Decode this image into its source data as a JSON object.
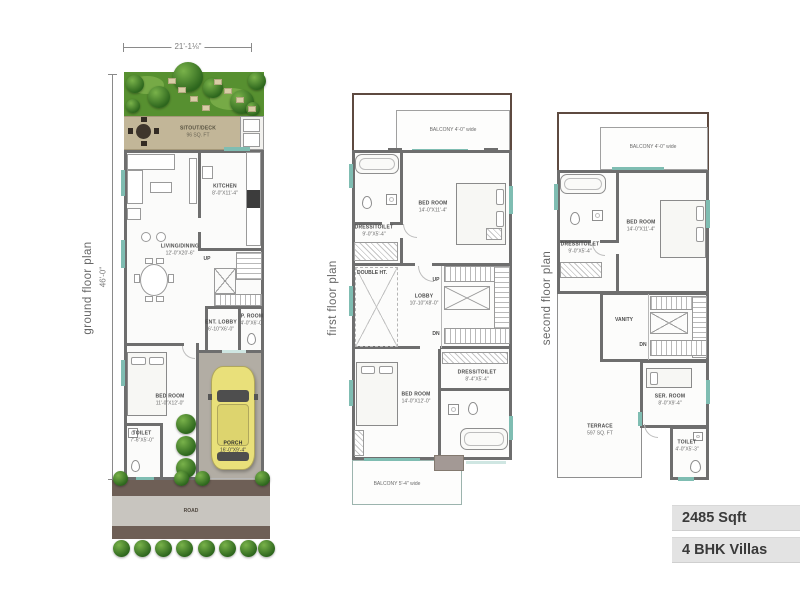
{
  "badges": {
    "area": "2485 Sqft",
    "type": "4 BHK Villas"
  },
  "ground_floor": {
    "title": "ground floor plan",
    "width_dim": "21'-1⅛\"",
    "height_dim": "46'-0\"",
    "sitout": {
      "name": "SITOUT/DECK",
      "dims": "96 SQ. FT"
    },
    "kitchen": {
      "name": "KITCHEN",
      "dims": "8'-0\"X11'-4\""
    },
    "living": {
      "name": "LIVING/DINING",
      "dims": "12'-0\"X20'-6\""
    },
    "up": "UP",
    "ent_lobby": {
      "name": "ENT. LOBBY",
      "dims": "6'-10\"X6'-0\""
    },
    "p_room": {
      "name": "P. ROOM",
      "dims": "4'-0\"X6'-0\""
    },
    "bedroom": {
      "name": "BED ROOM",
      "dims": "11'-0\"X12'-0\""
    },
    "toilet": {
      "name": "TOILET",
      "dims": "7'-6\"X5'-0\""
    },
    "porch": {
      "name": "PORCH",
      "dims": "16'-0\"X9'-4\""
    },
    "road": "ROAD"
  },
  "first_floor": {
    "title": "first floor plan",
    "balcony_top": "BALCONY 4'-0\" wide",
    "dress_toilet_top": {
      "name": "DRESS/TOILET",
      "dims": "9'-0\"X5'-4\""
    },
    "bedroom_top": {
      "name": "BED ROOM",
      "dims": "14'-0\"X11'-4\""
    },
    "double_ht": "DOUBLE HT.",
    "lobby": {
      "name": "LOBBY",
      "dims": "10'-10\"X8'-0\""
    },
    "up": "UP",
    "dn": "DN",
    "bedroom_bottom": {
      "name": "BED ROOM",
      "dims": "14'-0\"X12'-0\""
    },
    "dress_toilet_bottom": {
      "name": "DRESS/TOILET",
      "dims": "8'-4\"X5'-4\""
    },
    "balcony_bottom": "BALCONY 5'-4\" wide"
  },
  "second_floor": {
    "title": "second floor plan",
    "balcony_top": "BALCONY 4'-0\" wide",
    "dress_toilet": {
      "name": "DRESS/TOILET",
      "dims": "9'-0\"X5'-4\""
    },
    "bedroom": {
      "name": "BED ROOM",
      "dims": "14'-0\"X11'-4\""
    },
    "vanity": "VANITY",
    "dn": "DN",
    "ser_room": {
      "name": "SER. ROOM",
      "dims": "8'-0\"X9'-4\""
    },
    "terrace": {
      "name": "TERRACE",
      "dims": "597 SQ. FT"
    },
    "toilet": {
      "name": "TOILET",
      "dims": "4'-0\"X5'-3\""
    }
  },
  "colors": {
    "wall": "#6e6e6e",
    "line": "#9c9c9c",
    "thin": "#b8b8b8",
    "teal": "#7fbdb2",
    "teal_light": "#cfe6e2",
    "garden": "#579030",
    "tree_dark": "#2d661d",
    "tree_light": "#79b24a",
    "stone": "#d8cda6",
    "tan": "#c2b698",
    "porch": "#b2ada4",
    "car": "#e9e07a",
    "car_glass": "#4e4e4e",
    "road_dark": "#6e5f56",
    "road_light": "#c8c5bf",
    "brown": "#5e4a40",
    "badge_bg": "#e3e3e3",
    "badge_text": "#3a3a3a",
    "dim": "#8a8a8a"
  }
}
